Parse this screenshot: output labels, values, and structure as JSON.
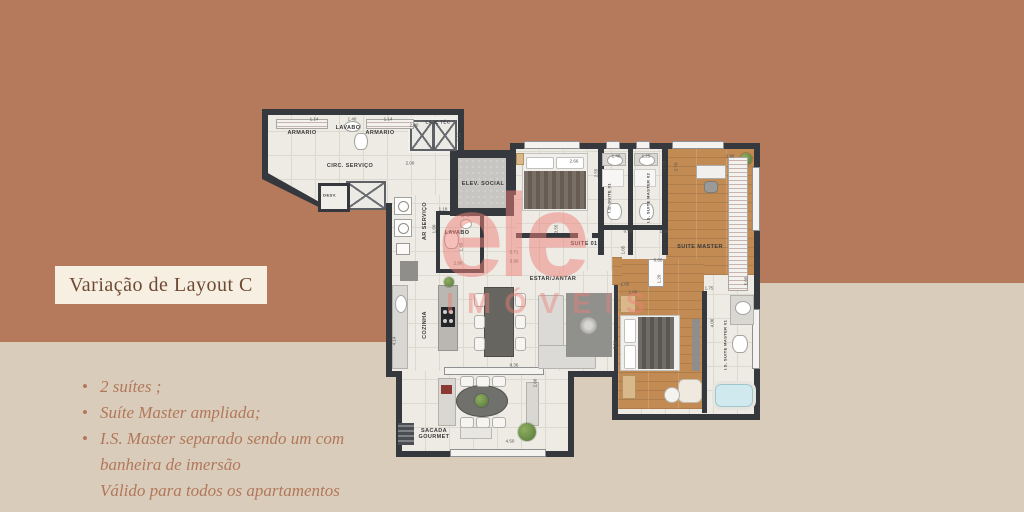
{
  "colors": {
    "terracotta": "#b5795b",
    "beige": "#d9ccba",
    "title_bg": "#f7efe2",
    "title_text": "#6f4a33",
    "note_text": "#b2775a",
    "wall": "#35383d",
    "floor": "#edebe4",
    "floor_grid": "#dcd9d1",
    "wood": "#c28b53",
    "concrete": "#c8c6c2",
    "bathtub": "#cfe9ee",
    "watermark": "#ee8078"
  },
  "title": "Variação de Layout C",
  "notes": {
    "bullets": [
      "2 suítes ;",
      "Suíte Master ampliada;",
      "I.S. Master separado sendo um com banheira de imersão"
    ],
    "footnote": "Válido para todos os apartamentos"
  },
  "watermark": {
    "logo": "ele",
    "subtitle": "IMÓVEIS"
  },
  "floorplan": {
    "room_labels": [
      {
        "id": "armario-1",
        "text": "ARMARIO",
        "x": 40,
        "y": 38
      },
      {
        "id": "lavabo-servico",
        "text": "LAVABO",
        "x": 86,
        "y": 33
      },
      {
        "id": "armario-2",
        "text": "ARMARIO",
        "x": 118,
        "y": 38
      },
      {
        "id": "circ-servico",
        "text": "CIRC. SERVIÇO",
        "x": 88,
        "y": 71
      },
      {
        "id": "desv",
        "text": "DESV.",
        "x": 68,
        "y": 100,
        "size": 4
      },
      {
        "id": "laje-tec",
        "text": "LAJE TÉC",
        "x": 176,
        "y": 27,
        "size": 4.5
      },
      {
        "id": "elev-social",
        "text": "ELEV. SOCIAL",
        "x": 221,
        "y": 89
      },
      {
        "id": "ar-servico",
        "text": "AR SERVIÇO",
        "x": 163,
        "y": 126,
        "vertical": true
      },
      {
        "id": "lavabo",
        "text": "LAVABO",
        "x": 195,
        "y": 138
      },
      {
        "id": "cozinha",
        "text": "COZINHA",
        "x": 163,
        "y": 230,
        "vertical": true
      },
      {
        "id": "estar-jantar",
        "text": "ESTAR/JANTAR",
        "x": 291,
        "y": 184
      },
      {
        "id": "suite-01",
        "text": "SUITE 01",
        "x": 322,
        "y": 149
      },
      {
        "id": "is-suite-01",
        "text": "I.S. SUITE 01",
        "x": 347,
        "y": 103,
        "vertical": true,
        "size": 4
      },
      {
        "id": "is-suite-master-02",
        "text": "I.S. SUITE MASTER 02",
        "x": 386,
        "y": 103,
        "vertical": true,
        "size": 4
      },
      {
        "id": "suite-master",
        "text": "SUITE MASTER",
        "x": 438,
        "y": 152
      },
      {
        "id": "is-suite-master-01",
        "text": "I.S. SUITE MASTER 01",
        "x": 463,
        "y": 250,
        "vertical": true,
        "size": 4
      },
      {
        "id": "sacada-gourmet",
        "text": "SACADA GOURMET",
        "x": 172,
        "y": 339,
        "w": 46
      }
    ],
    "dim_labels": [
      {
        "text": "1.14",
        "x": 52,
        "y": 24
      },
      {
        "text": "1.40",
        "x": 90,
        "y": 24
      },
      {
        "text": "1.14",
        "x": 126,
        "y": 24
      },
      {
        "text": "2.00",
        "x": 152,
        "y": 30
      },
      {
        "text": "1.10",
        "x": 197,
        "y": 42,
        "vertical": true
      },
      {
        "text": "2.00",
        "x": 148,
        "y": 68
      },
      {
        "text": "1.18",
        "x": 181,
        "y": 114
      },
      {
        "text": "1.42",
        "x": 203,
        "y": 120
      },
      {
        "text": "1.60",
        "x": 172,
        "y": 134,
        "vertical": true
      },
      {
        "text": "1.65",
        "x": 199,
        "y": 152,
        "vertical": true
      },
      {
        "text": "2.90",
        "x": 196,
        "y": 168
      },
      {
        "text": "5.71",
        "x": 252,
        "y": 157
      },
      {
        "text": "3.90",
        "x": 252,
        "y": 166
      },
      {
        "text": "3.55",
        "x": 294,
        "y": 134,
        "vertical": true
      },
      {
        "text": "2.66",
        "x": 312,
        "y": 66
      },
      {
        "text": "2.55",
        "x": 334,
        "y": 78,
        "vertical": true
      },
      {
        "text": "1.40",
        "x": 354,
        "y": 61
      },
      {
        "text": "1.25",
        "x": 384,
        "y": 61
      },
      {
        "text": "2.55",
        "x": 402,
        "y": 70,
        "vertical": true
      },
      {
        "text": "2.70",
        "x": 414,
        "y": 72,
        "vertical": true
      },
      {
        "text": "2.90",
        "x": 468,
        "y": 61
      },
      {
        "text": "0.90",
        "x": 366,
        "y": 136
      },
      {
        "text": "1.24",
        "x": 402,
        "y": 136
      },
      {
        "text": "1.05",
        "x": 361,
        "y": 155,
        "vertical": true
      },
      {
        "text": "0.80",
        "x": 396,
        "y": 165
      },
      {
        "text": "1.20",
        "x": 397,
        "y": 184,
        "vertical": true
      },
      {
        "text": "1.65",
        "x": 363,
        "y": 189
      },
      {
        "text": "1.68",
        "x": 371,
        "y": 197
      },
      {
        "text": "2.00",
        "x": 353,
        "y": 250,
        "vertical": true
      },
      {
        "text": "1.75",
        "x": 447,
        "y": 193
      },
      {
        "text": "4.06",
        "x": 450,
        "y": 228,
        "vertical": true
      },
      {
        "text": "5.05",
        "x": 484,
        "y": 186,
        "vertical": true
      },
      {
        "text": "8.36",
        "x": 252,
        "y": 270
      },
      {
        "text": "4.14",
        "x": 132,
        "y": 246,
        "vertical": true
      },
      {
        "text": "4.50",
        "x": 248,
        "y": 346
      },
      {
        "text": "2.66",
        "x": 273,
        "y": 288,
        "vertical": true
      }
    ]
  }
}
